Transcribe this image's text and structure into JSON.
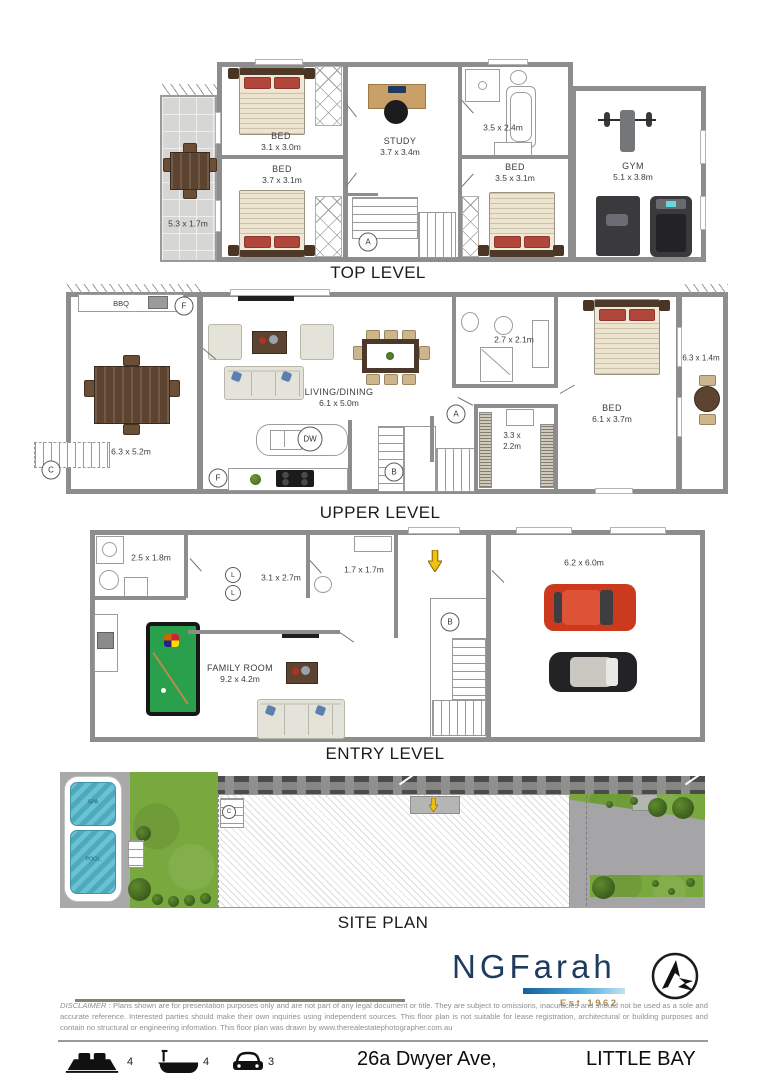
{
  "levels": {
    "top": {
      "title": "TOP LEVEL",
      "balcony_dims": "5.3 x 1.7m",
      "bed1_label": "BED",
      "bed1_dims": "3.1 x 3.0m",
      "bed2_label": "BED",
      "bed2_dims": "3.7 x 3.1m",
      "study_label": "STUDY",
      "study_dims": "3.7 x 3.4m",
      "bath_dims": "3.5 x 2.4m",
      "bed3_label": "BED",
      "bed3_dims": "3.5 x 3.1m",
      "gym_label": "GYM",
      "gym_dims": "5.1 x 3.8m",
      "stair_marker": "A"
    },
    "upper": {
      "title": "UPPER LEVEL",
      "bbq_label": "BBQ",
      "terrace_dims": "6.3 x 5.2m",
      "living_label": "LIVING/DINING",
      "living_dims": "6.1 x 5.0m",
      "bath_dims": "2.7 x 2.1m",
      "robe_dims_line1": "3.3 x",
      "robe_dims_line2": "2.2m",
      "bed_label": "BED",
      "bed_dims": "6.1 x 3.7m",
      "balcony_dims": "6.3 x 1.4m",
      "fridge_marker": "F",
      "fridge2_marker": "F",
      "dishwasher_marker": "DW",
      "stair_marker_a": "A",
      "stair_marker_b": "B",
      "stair_marker_c": "C"
    },
    "entry": {
      "title": "ENTRY LEVEL",
      "laundry_dims": "2.5 x 1.8m",
      "hall_dims": "3.1 x 2.7m",
      "bath_dims": "1.7 x 1.7m",
      "family_label": "FAMILY ROOM",
      "family_dims": "9.2 x 4.2m",
      "garage_dims": "6.2 x 6.0m",
      "linen_marker_1": "L",
      "linen_marker_2": "L",
      "stair_marker": "B"
    },
    "site": {
      "title": "SITE PLAN",
      "spa_label": "SPA",
      "pool_label": "POOL",
      "stair_marker": "C"
    }
  },
  "branding": {
    "agency": "NGFarah",
    "est": "Est 1962"
  },
  "disclaimer": {
    "label": "DISCLAIMER",
    "text": " : Plans shown are for presentation purposes only and are not part of any legal document or title. They are subject to omissions, inacuracies and should not be used as a sole and accurate reference. Interested parties should make their own inquiries using independent sources. This floor plan is not suitable for lease registration, architectural or building purposes and contain no structural or engineering infomation. This floor plan was drawn by www.therealestatephotographer.com.au"
  },
  "footer": {
    "bed_count": "4",
    "bath_count": "4",
    "car_count": "3",
    "address": "26a Dwyer Ave,",
    "suburb": "LITTLE BAY"
  },
  "colors": {
    "brand_navy": "#1e3c5e",
    "brand_gold": "#b08a4a",
    "logo_bar_blue": "#4aa3d8",
    "carpet_grey": "#515157",
    "timber": "#c08a55",
    "pool_table_green": "#2aa04c",
    "car_red": "#cc3a1e",
    "water_blue": "#57b5c7",
    "lawn_green": "#79a83e",
    "entry_arrow_yellow": "#f2c011"
  }
}
